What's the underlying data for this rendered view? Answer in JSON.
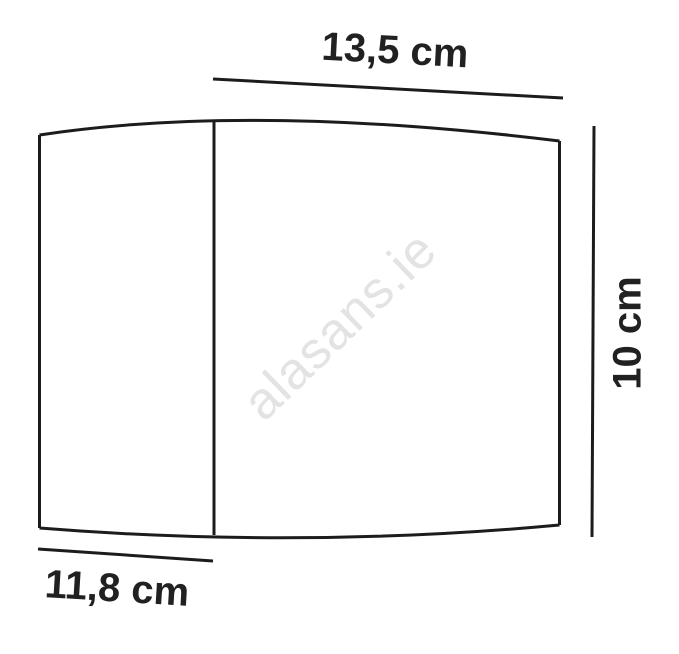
{
  "diagram": {
    "labels": {
      "top_width": "13,5 cm",
      "side_height": "10 cm",
      "bottom_depth": "11,8 cm"
    },
    "watermark": "alasans.ie",
    "colors": {
      "line": "#1c1c1c",
      "label_text": "#212121",
      "watermark": "#e3e3e3",
      "background": "#ffffff"
    }
  }
}
